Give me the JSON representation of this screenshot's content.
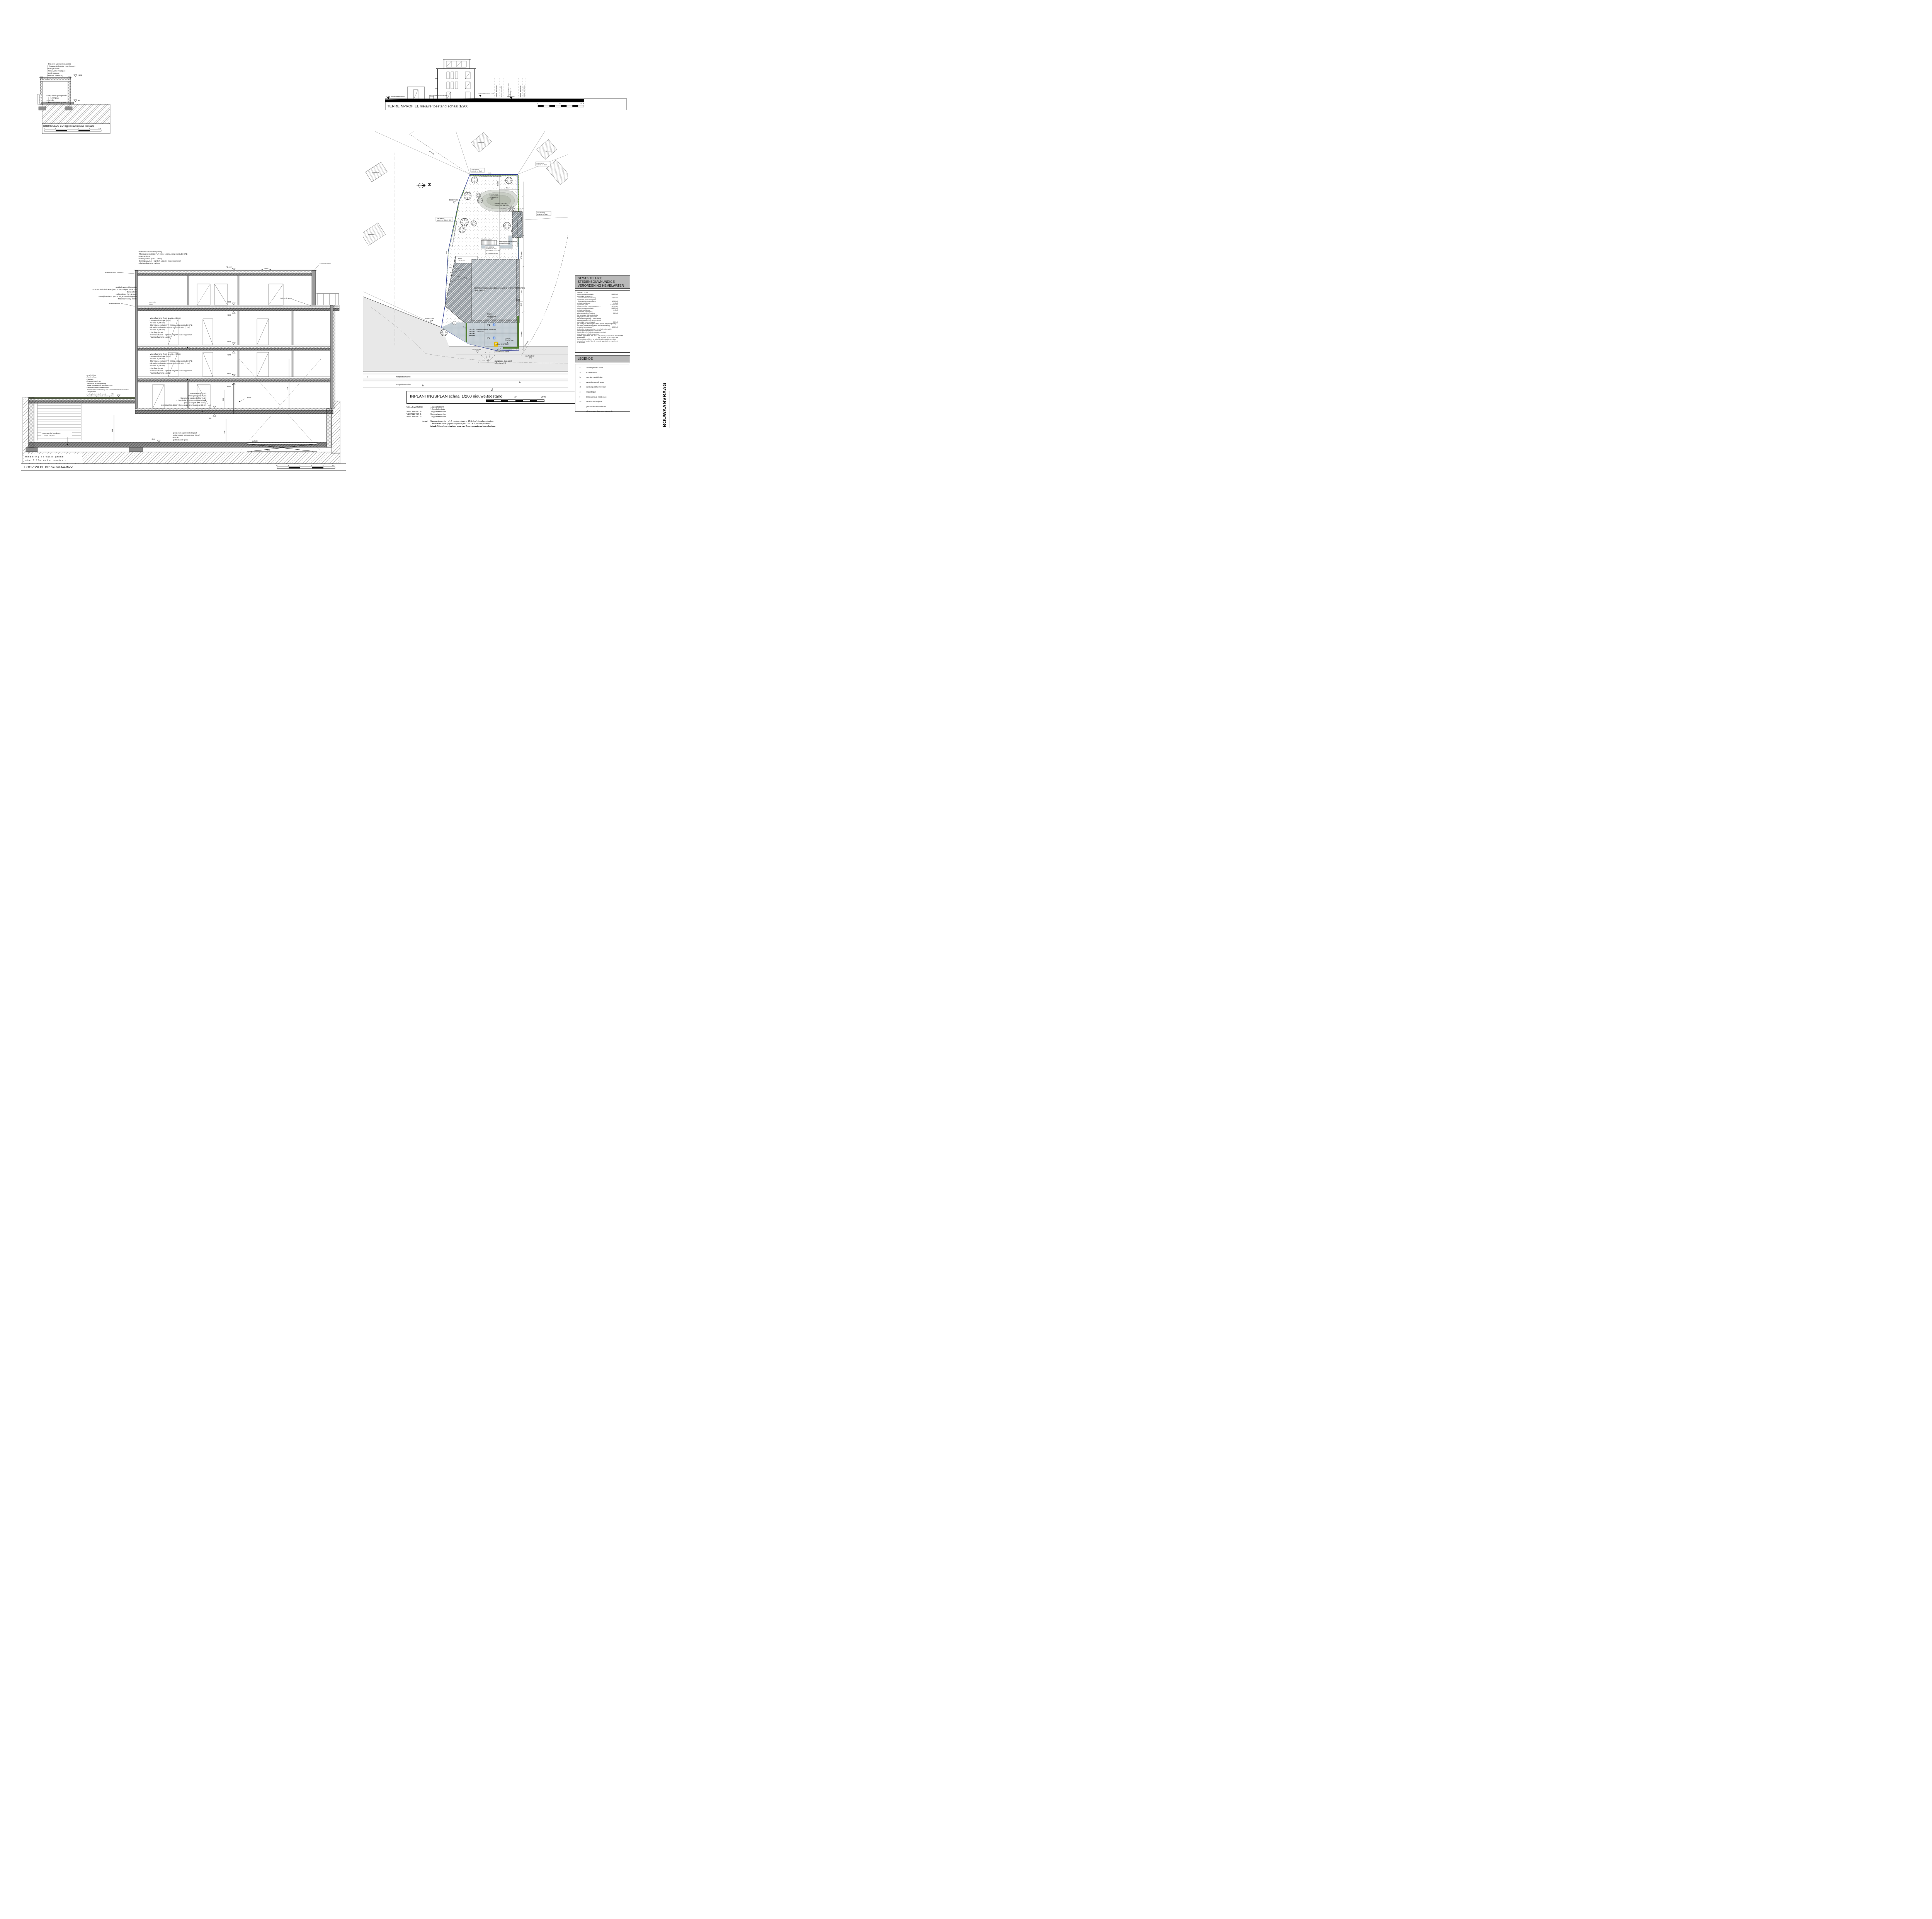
{
  "page": {
    "vertical_label": "BOUWAANVRAAG"
  },
  "cc": {
    "title": "DOORSNEDE CC' bijgebouw nieuwe toestand",
    "roof_notes": [
      "- Dubbele waterdichtingslaag",
      "- Thermische isolatie PUR (10 cm)",
      "- Dampscherm",
      "- Watervaste multiplex",
      "- Hellingsspiën",
      "- Houten roostering"
    ],
    "floor_notes": [
      "- Gepolierde gewapende",
      "        betonplaat",
      "- PE-folie",
      "- Gestabiliseerde grond"
    ],
    "perceelsgrens": "perceelsgrens",
    "level_top": "+300",
    "level_zero": "±0",
    "scale_ticks": [
      "0",
      "1",
      "2",
      "3",
      "4",
      "5 m"
    ]
  },
  "terrein": {
    "title": "TERREINPROFIEL nieuwe toestand schaal 1/200",
    "level_left": "33,78 mTAW bestaand maaiveld",
    "level_mid": "34,15 mTAW nieuwe 0-pas",
    "level_right": "33,78 mTAW",
    "note_small": "huidig profiel gelijk aan toekomstig profiel",
    "street1": "voetpad betondallen",
    "street2": "parkeerhaven asfalt",
    "street3a": "rijweg Grote Baan asfalt",
    "street3b": "gewestweg N12",
    "street4": "fietspad betondallen",
    "street5": "voetpad betondallen",
    "scale_ticks": [
      "0",
      "10",
      "20 m"
    ]
  },
  "plan": {
    "title": "INPLANTINGSPLAN schaal 1/200 nieuwe toestand",
    "scale_ticks": [
      "0",
      "10",
      "20 m"
    ],
    "north": "N",
    "ten_meter": "10 meter",
    "afd": "1ste afdeling",
    "p38z4": "sectie A, nr. 38z4",
    "p38b5": "sectie A, nr. 38b5",
    "p38a6": "sectie A, nr. 38a6",
    "p38p4": "sectie A, nr. 38p4 & 38t3",
    "p38y4": "sectie A, nr. 38y4",
    "y4opp": "perceelsopp. 1.317 m2",
    "y4tuin": "in te richten als tuin",
    "bijgebouw": "bijgebouw",
    "haag": "haag in bladhoudend groen op de perceelsgrenzen",
    "wadi1": "bodem wadi",
    "wadi2": "33,15mTAW",
    "wadi3": "wadi min. 28,02m2",
    "wadi4": "volume min. 8.518 liter",
    "lvl3378": "33,78mTAW",
    "lvl3395": "33,95mTAW",
    "lvl3398": "33,98mTAW",
    "dorpel1": "dorpel",
    "dorpel2": "34,15mTAW",
    "bldg1": "BOUWEN VAN EEN HANDELSRUIMTE & 9 APPARTEMENTEN",
    "bldg2": "Grote Baan 10",
    "terras1": "terras",
    "terras2": "13,70 m2",
    "bij1": "BOUWEN VAN EEN BIJGEBOUW",
    "bij2": "containerberging / fietsenberging",
    "vlucht": "vluchttrap kelder",
    "tuinpad1": "waterdoorlatende verharding",
    "tuinpad2": "tuinpad 33,36 m2",
    "verh1": "waterdoorlatende verharding",
    "verh2": "113,62 m2",
    "p1": "P1",
    "p2": "P2",
    "wc": "♿",
    "street1": "voetpad betondallen",
    "street2": "parkeerhaven asfalt",
    "street3a": "rijweg Grote Baan asfalt",
    "street3b": "gewestweg N12",
    "street4": "fietspad betondallen",
    "street5": "voetpad betondallen",
    "d9000": "9,000",
    "d10000": "10,000",
    "d17000": "17,000",
    "d3000": "3,000",
    "d6574": "6,574",
    "d45120": "45,120",
    "b1666": "-16,66-",
    "b1148": "-11,48-",
    "b2418": "-24,18-",
    "b2616": "-26,16-",
    "b4908": "-49,08-",
    "b1539": "-15,39-",
    "b637": "-6,37-",
    "le": "e",
    "lb": "b",
    "lf": "f",
    "ld": "d",
    "n1": "1",
    "n2": "2",
    "n3": "3",
    "n4": "4",
    "n5": "5",
    "n6": "6",
    "n7": "7",
    "n8": "8"
  },
  "bb": {
    "title": "DOORSNEDE BB' nieuwe toestand",
    "roof_notes": [
      "- Dubbele waterdichtingslaag",
      "- Thermische isolatie PUR (min. 16 cm), volgens studie EPB",
      "- Dampscherm",
      "- Hellingsbeton (min. 1 cm/m)",
      "- Breedplaatvloer + opstort, volgens studie ingenieur",
      "- Plafondafwerking pleister"
    ],
    "floor_notes": [
      "- Vloerafwerking (hout, tegels,...) (2 cm)",
      "- Gewapende chape (8 cm)",
      "- Pe-folie (0,02 cm)",
      "- Thermische isolatie PIR (3 cm), volgens studie EPB",
      "- Akoestische isolatie INSULCO insulit Bi+9 (1 cm)",
      "- Pe-folie (0,02 cm)",
      "- Uitvulling (6 cm)",
      "- Breedplaatvloer + opstort, volgens studie ingenieur",
      "- Plafondafwerking pleister"
    ],
    "ground_notes": [
      "- Vloerafwerking (2 cm)",
      "- Chape gewapend (7 cm)",
      "- Akoestische isolatie Abrifiber (1cm)",
      "- Thermische isolatie EPS-isolatiechape",
      "  (min. 20 cm) cfr. EPB-verslag",
      "- Betonplaat / predallen volgens studie betoningenieur (30 cm)"
    ],
    "groendak_notes": [
      "- Vegetatielaag",
      "- Substraatlaag",
      "- Filterlaag",
      "- Drainage-laag (5 cm)",
      "- Bescherm- en absorptielaag",
      "   totale dikte extensief groendak 30 cm",
      "- Dakdichtingslaag (wortelwerend)",
      "- Thermische isolatie PUR (5 cm) samendrukbaarheidsklasse P4",
      "- Dampscherm",
      "- Hellingsbeton (min. 1 cm/m)",
      "- Predallen volgens studie betoningenieur"
    ],
    "kelder_notes": [
      "- gewapende gepolierde betonplaat",
      "   volgens studie betoningenieur (30 cm)",
      "- PE-folie",
      "- gestabiliseerde grond"
    ],
    "rwa1": "RWA opening brand 6m2",
    "rwa2": "2 x 2,50 x 1,20m",
    "fund1": "fundering op vaste grond",
    "fund2": "min. 0,80m onder maaiveld",
    "iso": "isolerende steen",
    "iso1": "isolerende",
    "iso2": "steen",
    "poort": "poort",
    "autolift": "autolift",
    "l1162": "+1.162",
    "l900": "+900",
    "l860": "+860",
    "l610": "+610",
    "l570": "+570",
    "l320": "+320",
    "l280": "+280",
    "l0": "±0",
    "lm55": "-55",
    "lm86": "-86",
    "lm315": "-315",
    "lm375": "-375",
    "d280": "280",
    "d229": "229",
    "d260": "260",
    "d595": "595",
    "scale_ticks": [
      "0",
      "1",
      "2",
      "3",
      "4",
      "5 m"
    ]
  },
  "hemelwater": {
    "title1": "GEWESTELIJKE STEDENBOUWKUNDIGE",
    "title2": "VERORDENING HEMELWATER",
    "lines": [
      {
        "t": "OPPERVLAKTES",
        "v": ""
      },
      {
        "t": "horizontale dakoppervlakte:",
        "v": "396,29 m2"
      },
      {
        "t": "oppervlakte toegangen in",
        "v": ""
      },
      {
        "t": "   waterdoorlatende verharding:",
        "v": "113,00 m2"
      },
      {
        "t": "oppervlakte terras en tuinpad in",
        "v": ""
      },
      {
        "t": "   waterdoorlatende verharding:",
        "v": "47,06 m2"
      },
      {
        "t": "verharding keldertrap:",
        "v": "4,43m2"
      },
      {
        "t": "oppervlakte goed:",
        "v": "1.317,00 m2"
      },
      {
        "t": "",
        "v": ""
      },
      {
        "t": "AFWATERENDE OPPERVLAKTES ->",
        "v": "340,72 m2"
      },
      {
        "t": "horizontale dakoppervlakte:",
        "v": "396,29 m2"
      },
      {
        "t": "verharding keldertrap:",
        "v": "4,43m2"
      },
      {
        "t": "oppervlakte toegangen in",
        "v": ""
      },
      {
        "t": "waterdoorlatende verharding:",
        "v": "0,00 m2"
      },
      {
        "t": "(de aanleg van strikt noodzakelijke",
        "v": ""
      },
      {
        "t": "toegangen naar een gebouw zijn",
        "v": ""
      },
      {
        "t": "niet vergunningplichtig -> valt buiten het",
        "v": ""
      },
      {
        "t": "toepassingsgebied van de verordening)",
        "v": ""
      },
      {
        "t": "oppervlakte terras en tuinpad:",
        "v": "0,00 m2"
      },
      {
        "t": "(de aanleg van verhardingen < 80m2 zijn niet vergunningplichtig ->",
        "v": ""
      },
      {
        "t": "valt buiten het toepassingsgebied van de verordening)",
        "v": ""
      },
      {
        "t": "verplichte hemelwaterput",
        "v": "-60,00 m2"
      },
      {
        "t": "",
        "v": ""
      },
      {
        "t": "Anders dan ééngezinswoning -> hemelwaterput verplicht:",
        "v": ""
      },
      {
        "t": "inhoud hemelwaterput: min. 10.000 liter",
        "v": ""
      },
      {
        "t": "",
        "v": ""
      },
      {
        "t": "Goed > 250 m2 -> infiltratievoorziening verplicht:",
        "v": ""
      },
      {
        "t": "dimensioneren infiltratievoorziening:",
        "v": ""
      },
      {
        "t": "infiltratie oppervlakte:  min. 4m2 x (340,72/100) = 13,62 m2 of 28,02m2 wadi",
        "v": ""
      },
      {
        "t": "buffervolume:",
        "v": "min. 25l x 340,75 m2 = 8.518 liter"
      },
      {
        "t": "",
        "v": ""
      },
      {
        "t": "Het hemelwater infiltreert op natuurlijke wijze naast de overdekte",
        "v": ""
      },
      {
        "t": "constructie of naast of door de verharde oppervlakte op eigen terrein",
        "v": ""
      },
      {
        "t": "in de bodem.",
        "v": ""
      }
    ]
  },
  "legende": {
    "title": "LEGENDE",
    "rows": [
      {
        "sym": "<",
        "label": "opnamepunten foto's"
      },
      {
        "sym": "a",
        "label": "TV-distributie"
      },
      {
        "sym": "b",
        "label": "openbare verlichting"
      },
      {
        "sym": "c",
        "label": "aansluitpunt vuil water"
      },
      {
        "sym": "d",
        "label": "aansluitpunt hemelwater"
      },
      {
        "sym": "e",
        "label": "inspectieput"
      },
      {
        "sym": "f",
        "label": "distributiekast electriciteit"
      },
      {
        "sym": "EL",
        "label": "electrische laadpaal"
      },
      {
        "sym": "",
        "label": "geen erfdienstbaarheden"
      },
      {
        "sym": "",
        "label": "alle nutsvoorzieningen aanwezig"
      }
    ]
  },
  "stats": {
    "rows": [
      {
        "k": "GELIJKVLOERS:",
        "v": "1 appartement"
      },
      {
        "k": "",
        "v": "1 handelsruimte"
      },
      {
        "k": "VERDIEPING 1:",
        "v": "3 appartementen"
      },
      {
        "k": "VERDIEPING 2:",
        "v": "3 appartementen"
      },
      {
        "k": "VERDIEPING 3:",
        "v": "2 appartementen"
      }
    ],
    "totaal_label": "totaal:",
    "totals": [
      {
        "b": "9 appartementen",
        "r": " x 1,5 parkeerplaats = 13,5 dus 14 parkeerplaatsen"
      },
      {
        "b": "1 handelsruimte",
        "r": " (1 parkeerplaats per 75m2 = 2 parkeerplaatsen"
      },
      {
        "b": "totaal: 16 parkeerplaatsen waarvan 2 aangepaste parkeerplaatsen",
        "r": ""
      }
    ]
  }
}
